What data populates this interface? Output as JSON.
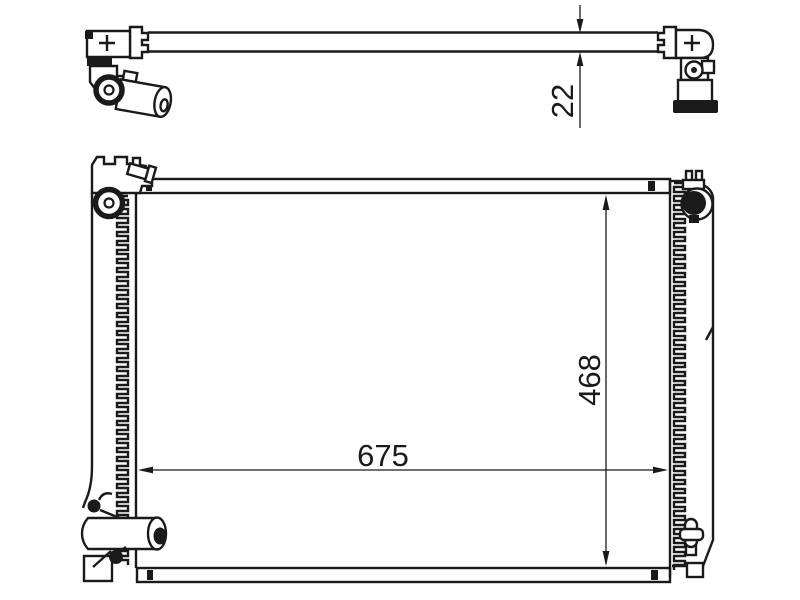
{
  "dimensions": {
    "thickness": "22",
    "width": "675",
    "height": "468"
  },
  "colors": {
    "line": "#1a1a1a",
    "background": "#ffffff"
  }
}
